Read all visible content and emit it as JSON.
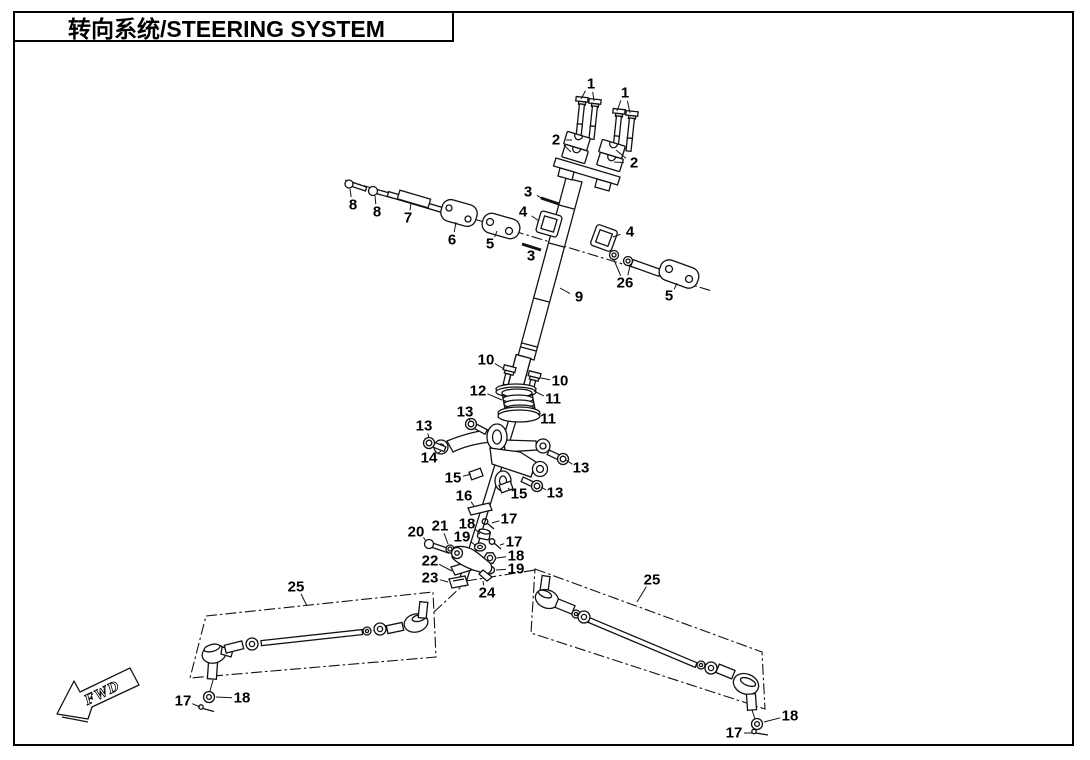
{
  "title": {
    "text": "转向系统/STEERING SYSTEM"
  },
  "direction_marker": {
    "label": "FWD"
  },
  "colors": {
    "ink": "#111111",
    "paper": "#ffffff"
  },
  "diagram": {
    "kind": "exploded-parts-view",
    "part_numbers_shown": [
      "1",
      "2",
      "3",
      "4",
      "5",
      "6",
      "7",
      "8",
      "9",
      "10",
      "11",
      "12",
      "13",
      "14",
      "15",
      "16",
      "17",
      "18",
      "19",
      "20",
      "21",
      "22",
      "23",
      "24",
      "25",
      "26"
    ],
    "callouts": [
      {
        "label": "1",
        "x": 591,
        "y": 84,
        "t": [
          [
            581,
            99
          ],
          [
            594,
            101
          ]
        ]
      },
      {
        "label": "1",
        "x": 625,
        "y": 93,
        "t": [
          [
            617,
            111
          ],
          [
            630,
            113
          ]
        ]
      },
      {
        "label": "2",
        "x": 556,
        "y": 140,
        "t": [
          [
            572,
            140
          ],
          [
            571,
            152
          ]
        ]
      },
      {
        "label": "2",
        "x": 634,
        "y": 163,
        "t": [
          [
            616,
            150
          ],
          [
            614,
            162
          ]
        ]
      },
      {
        "label": "3",
        "x": 528,
        "y": 192,
        "t": [
          [
            545,
            200
          ]
        ]
      },
      {
        "label": "3",
        "x": 531,
        "y": 256,
        "t": [
          [
            530,
            248
          ]
        ]
      },
      {
        "label": "4",
        "x": 523,
        "y": 212,
        "t": [
          [
            539,
            221
          ]
        ]
      },
      {
        "label": "4",
        "x": 630,
        "y": 232,
        "t": [
          [
            613,
            237
          ]
        ]
      },
      {
        "label": "5",
        "x": 490,
        "y": 244,
        "t": [
          [
            497,
            231
          ]
        ]
      },
      {
        "label": "5",
        "x": 669,
        "y": 296,
        "t": [
          [
            677,
            283
          ]
        ]
      },
      {
        "label": "6",
        "x": 452,
        "y": 240,
        "t": [
          [
            456,
            222
          ]
        ]
      },
      {
        "label": "7",
        "x": 408,
        "y": 218,
        "t": [
          [
            411,
            203
          ]
        ]
      },
      {
        "label": "8",
        "x": 353,
        "y": 205,
        "t": [
          [
            350,
            189
          ]
        ]
      },
      {
        "label": "8",
        "x": 377,
        "y": 212,
        "t": [
          [
            375,
            196
          ]
        ]
      },
      {
        "label": "9",
        "x": 579,
        "y": 297,
        "t": [
          [
            560,
            288
          ]
        ]
      },
      {
        "label": "10",
        "x": 486,
        "y": 360,
        "t": [
          [
            504,
            369
          ]
        ]
      },
      {
        "label": "10",
        "x": 560,
        "y": 381,
        "t": [
          [
            541,
            378
          ]
        ]
      },
      {
        "label": "11",
        "x": 553,
        "y": 399,
        "t": [
          [
            534,
            391
          ]
        ]
      },
      {
        "label": "11",
        "x": 548,
        "y": 419,
        "t": [
          [
            538,
            414
          ]
        ]
      },
      {
        "label": "12",
        "x": 478,
        "y": 391,
        "t": [
          [
            502,
            400
          ]
        ]
      },
      {
        "label": "13",
        "x": 465,
        "y": 412,
        "t": [
          [
            470,
            422
          ]
        ]
      },
      {
        "label": "13",
        "x": 424,
        "y": 426,
        "t": [
          [
            429,
            438
          ]
        ]
      },
      {
        "label": "13",
        "x": 581,
        "y": 468,
        "t": [
          [
            566,
            460
          ]
        ]
      },
      {
        "label": "13",
        "x": 555,
        "y": 493,
        "t": [
          [
            541,
            487
          ]
        ]
      },
      {
        "label": "14",
        "x": 429,
        "y": 458,
        "t": [
          [
            441,
            451
          ]
        ]
      },
      {
        "label": "15",
        "x": 453,
        "y": 478,
        "t": [
          [
            471,
            474
          ]
        ]
      },
      {
        "label": "15",
        "x": 519,
        "y": 494,
        "t": [
          [
            508,
            488
          ]
        ]
      },
      {
        "label": "16",
        "x": 464,
        "y": 496,
        "t": [
          [
            474,
            506
          ]
        ]
      },
      {
        "label": "17",
        "x": 509,
        "y": 519,
        "t": [
          [
            492,
            523
          ]
        ]
      },
      {
        "label": "17",
        "x": 514,
        "y": 542,
        "t": [
          [
            500,
            545
          ]
        ]
      },
      {
        "label": "17",
        "x": 183,
        "y": 701,
        "t": [
          [
            200,
            707
          ]
        ]
      },
      {
        "label": "17",
        "x": 734,
        "y": 733,
        "t": [
          [
            753,
            733
          ]
        ]
      },
      {
        "label": "18",
        "x": 467,
        "y": 524,
        "t": [
          [
            480,
            534
          ]
        ]
      },
      {
        "label": "18",
        "x": 516,
        "y": 556,
        "t": [
          [
            497,
            558
          ]
        ]
      },
      {
        "label": "18",
        "x": 242,
        "y": 698,
        "t": [
          [
            216,
            697
          ]
        ]
      },
      {
        "label": "18",
        "x": 790,
        "y": 716,
        "t": [
          [
            764,
            722
          ]
        ]
      },
      {
        "label": "19",
        "x": 462,
        "y": 537,
        "t": [
          [
            476,
            546
          ]
        ]
      },
      {
        "label": "19",
        "x": 516,
        "y": 569,
        "t": [
          [
            496,
            570
          ]
        ]
      },
      {
        "label": "20",
        "x": 416,
        "y": 532,
        "t": [
          [
            426,
            541
          ]
        ]
      },
      {
        "label": "21",
        "x": 440,
        "y": 526,
        "t": [
          [
            448,
            544
          ]
        ]
      },
      {
        "label": "22",
        "x": 430,
        "y": 561,
        "t": [
          [
            452,
            571
          ]
        ]
      },
      {
        "label": "23",
        "x": 430,
        "y": 578,
        "t": [
          [
            448,
            582
          ]
        ]
      },
      {
        "label": "24",
        "x": 487,
        "y": 593,
        "t": [
          [
            483,
            581
          ]
        ]
      },
      {
        "label": "25",
        "x": 296,
        "y": 587,
        "t": [
          [
            307,
            606
          ]
        ]
      },
      {
        "label": "25",
        "x": 652,
        "y": 580,
        "t": [
          [
            637,
            602
          ]
        ]
      },
      {
        "label": "26",
        "x": 625,
        "y": 283,
        "t": [
          [
            614,
            260
          ],
          [
            630,
            266
          ]
        ]
      }
    ]
  }
}
